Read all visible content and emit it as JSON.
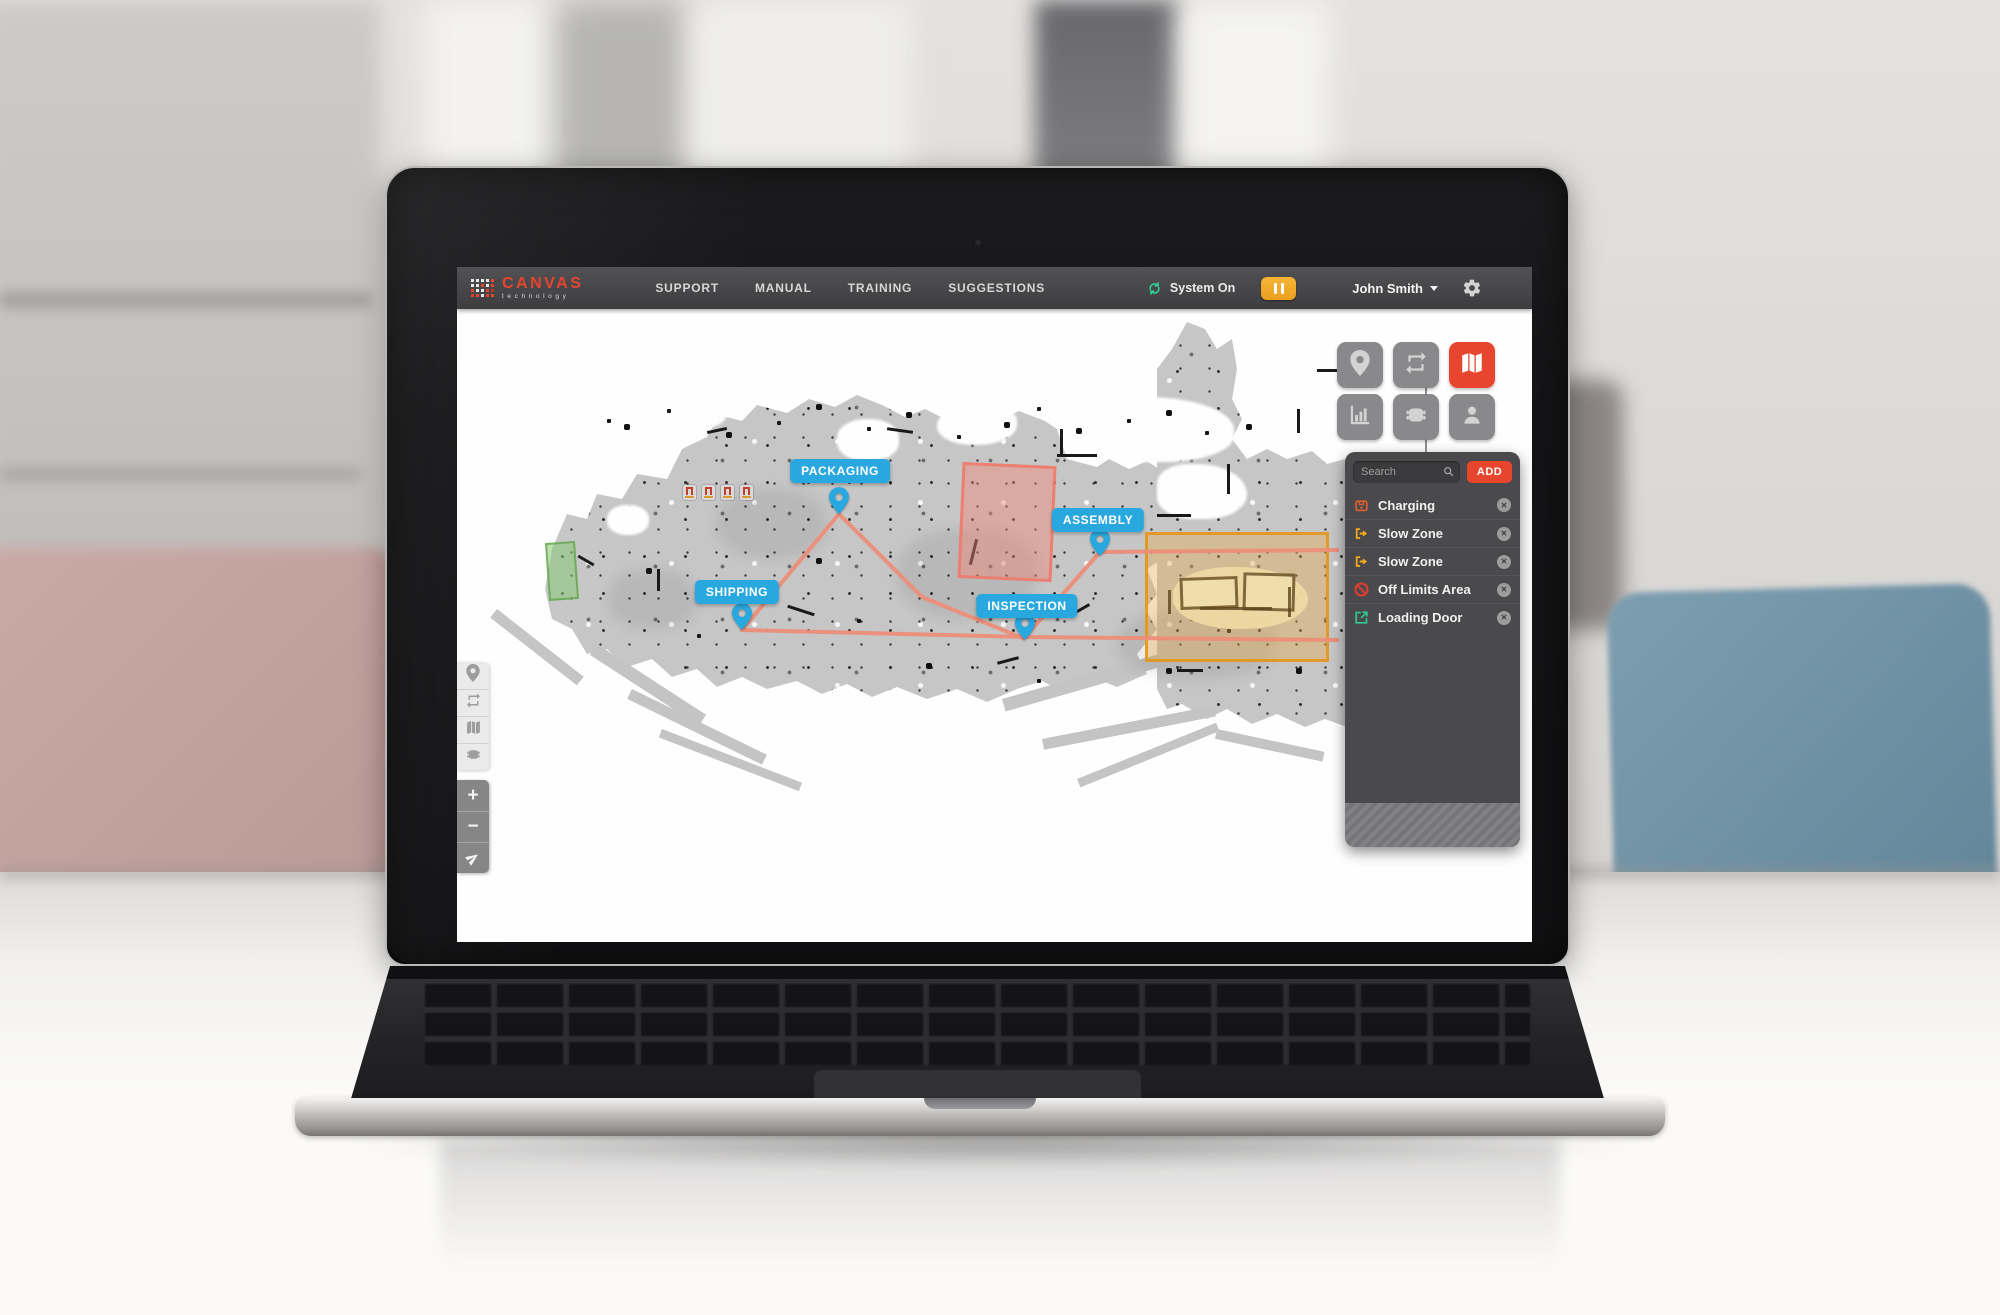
{
  "navbar": {
    "brand": {
      "name": "CANVAS",
      "tagline": "technology"
    },
    "items": [
      {
        "label": "SUPPORT"
      },
      {
        "label": "MANUAL"
      },
      {
        "label": "TRAINING"
      },
      {
        "label": "SUGGESTIONS"
      }
    ],
    "status": {
      "icon": "sync-icon",
      "label": "System On",
      "color": "#2ecc8f"
    },
    "pause_button": {
      "icon": "pause-icon",
      "color": "#f2a71b"
    },
    "user": {
      "name": "John Smith",
      "menu_icon": "caret-down-icon"
    },
    "settings_icon": "gear-icon"
  },
  "map": {
    "markers": [
      {
        "text": "PACKAGING"
      },
      {
        "text": "ASSEMBLY"
      },
      {
        "text": "SHIPPING"
      },
      {
        "text": "INSPECTION"
      }
    ],
    "marker_color": "#29a8e0",
    "route_color": "#ec8d78",
    "zones": [
      {
        "type": "off-limits",
        "color": "#ee7868"
      },
      {
        "type": "slow-zone",
        "color": "#e1961e"
      },
      {
        "type": "loading-door",
        "color": "#5aa046"
      }
    ]
  },
  "view_toolbar": {
    "active_color": "#e8452f",
    "buttons": [
      {
        "icon": "location-pin-icon",
        "active": false
      },
      {
        "icon": "routes-loop-icon",
        "active": false
      },
      {
        "icon": "map-icon",
        "active": true
      },
      {
        "icon": "stats-chart-icon",
        "active": false
      },
      {
        "icon": "robot-icon",
        "active": false
      },
      {
        "icon": "user-icon",
        "active": false
      }
    ]
  },
  "mini_toolbar": {
    "buttons": [
      {
        "icon": "location-pin-icon"
      },
      {
        "icon": "routes-loop-icon"
      },
      {
        "icon": "map-icon"
      },
      {
        "icon": "robot-icon"
      }
    ]
  },
  "zoom_controls": {
    "zoom_in": "+",
    "zoom_out": "−",
    "locate_icon": "navigate-arrow-icon"
  },
  "zones_panel": {
    "search": {
      "placeholder": "Search",
      "icon": "search-icon"
    },
    "add_button": {
      "label": "ADD",
      "color": "#e8452f"
    },
    "close_glyph": "✕",
    "items": [
      {
        "label": "Charging",
        "icon": "charging-station-icon",
        "accent": "#dd5f2e"
      },
      {
        "label": "Slow Zone",
        "icon": "slow-zone-icon",
        "accent": "#f0a81c"
      },
      {
        "label": "Slow Zone",
        "icon": "slow-zone-icon",
        "accent": "#f0a81c"
      },
      {
        "label": "Off Limits Area",
        "icon": "off-limits-icon",
        "accent": "#e23b2e"
      },
      {
        "label": "Loading Door",
        "icon": "loading-door-icon",
        "accent": "#2fc98f"
      }
    ]
  }
}
